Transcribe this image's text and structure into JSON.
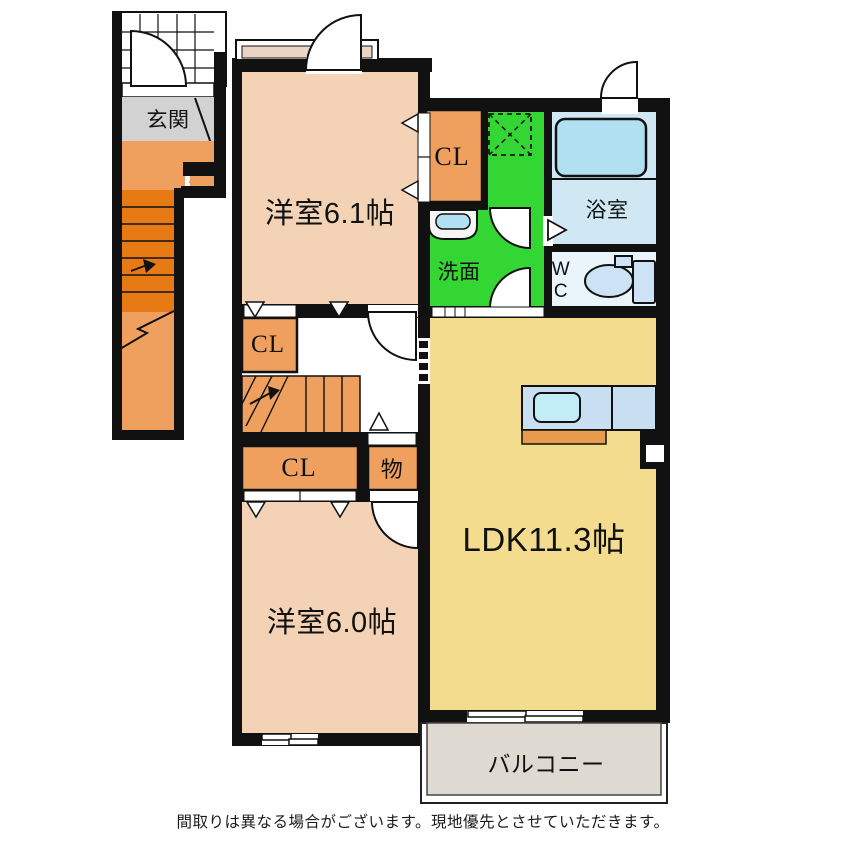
{
  "floorplan": {
    "entrance": {
      "label": "玄関"
    },
    "rooms": {
      "western1": {
        "label": "洋室6.1帖"
      },
      "western2": {
        "label": "洋室6.0帖"
      },
      "ldk": {
        "label": "LDK11.3帖"
      },
      "bathroom": {
        "label": "浴室"
      },
      "washroom": {
        "label": "洗面"
      },
      "toilet": {
        "label_line1": "W",
        "label_line2": "C"
      },
      "balcony": {
        "label": "バルコニー"
      },
      "closet_top": {
        "label": "CL"
      },
      "closet_mid": {
        "label": "CL"
      },
      "closet_bottom": {
        "label": "CL"
      },
      "storage": {
        "label": "物"
      }
    },
    "footer": {
      "disclaimer": "間取りは異なる場合がございます。現地優先とさせていただきます。"
    },
    "colors": {
      "wall": "#111111",
      "peach": "#f4d2b5",
      "orange": "#efa05f",
      "orange_dark": "#e87a16",
      "genkan_gray": "#d2d2d2",
      "green": "#33d633",
      "bath_blue": "#cfe8f4",
      "tub_blue": "#b0e0f2",
      "wc_bg": "#e9f4fb",
      "fixture_blue": "#cde2f5",
      "kitchen_blue": "#c9def1",
      "sink_cyan": "#c2ecf6",
      "ldk_yellow": "#f3dc8e",
      "balcony_gray": "#ded9d1",
      "counter_orange": "#e89b4d",
      "sill_beige": "#ead4c4"
    }
  }
}
